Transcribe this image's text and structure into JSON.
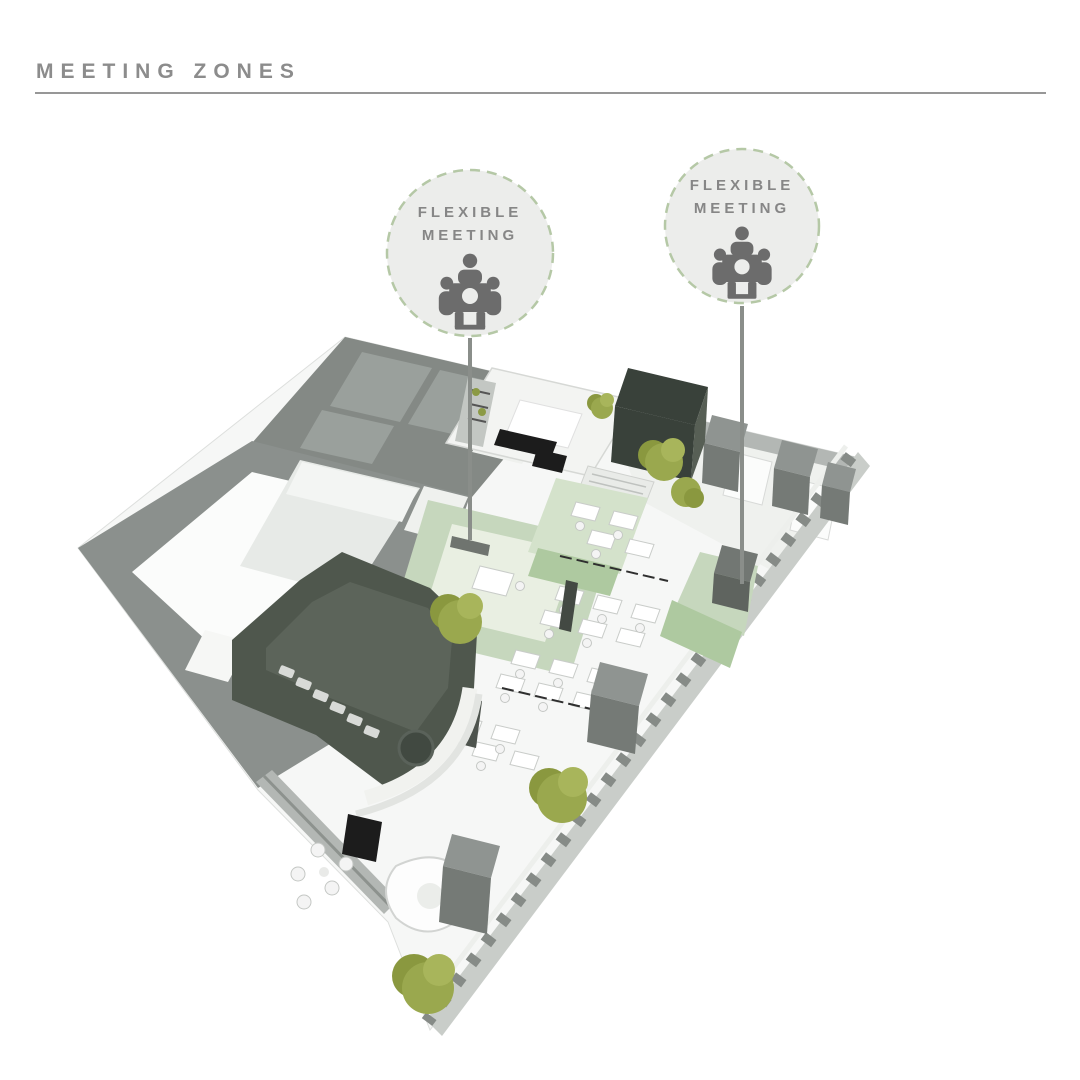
{
  "page": {
    "title": "MEETING ZONES"
  },
  "callouts": [
    {
      "label_line1": "FLEXIBLE",
      "label_line2": "MEETING",
      "icon": "meeting-table-people-icon",
      "target_zone": "left flexible meeting zone"
    },
    {
      "label_line1": "FLEXIBLE",
      "label_line2": "MEETING",
      "icon": "meeting-table-people-icon",
      "target_zone": "right flexible meeting zone"
    }
  ],
  "floor_plan": {
    "type": "isometric office floor plan render",
    "highlighted_zones": [
      "left flexible meeting zone",
      "right flexible meeting zone"
    ]
  },
  "colors": {
    "title-gray": "#8c8c8c",
    "rule-gray": "#979797",
    "accent-green": "#b5c8a6",
    "badge-fill": "#ecedeb",
    "badge-text-gray": "#868686",
    "icon-gray": "#6c6c6c",
    "leader-gray": "#8a8e8a",
    "zone-green": "#c6d7bd",
    "zone-green-bright": "#aec9a0",
    "zone-green-pale": "#e9efe2",
    "wall-gray": "#8b908d",
    "wall-gray-dark": "#6f746f",
    "wall-gray-light": "#b3b7b4",
    "olive-dark": "#4f574d",
    "olive-deep": "#39413a",
    "tree-green": "#9aa84e",
    "slab-gray": "#f6f7f6"
  }
}
